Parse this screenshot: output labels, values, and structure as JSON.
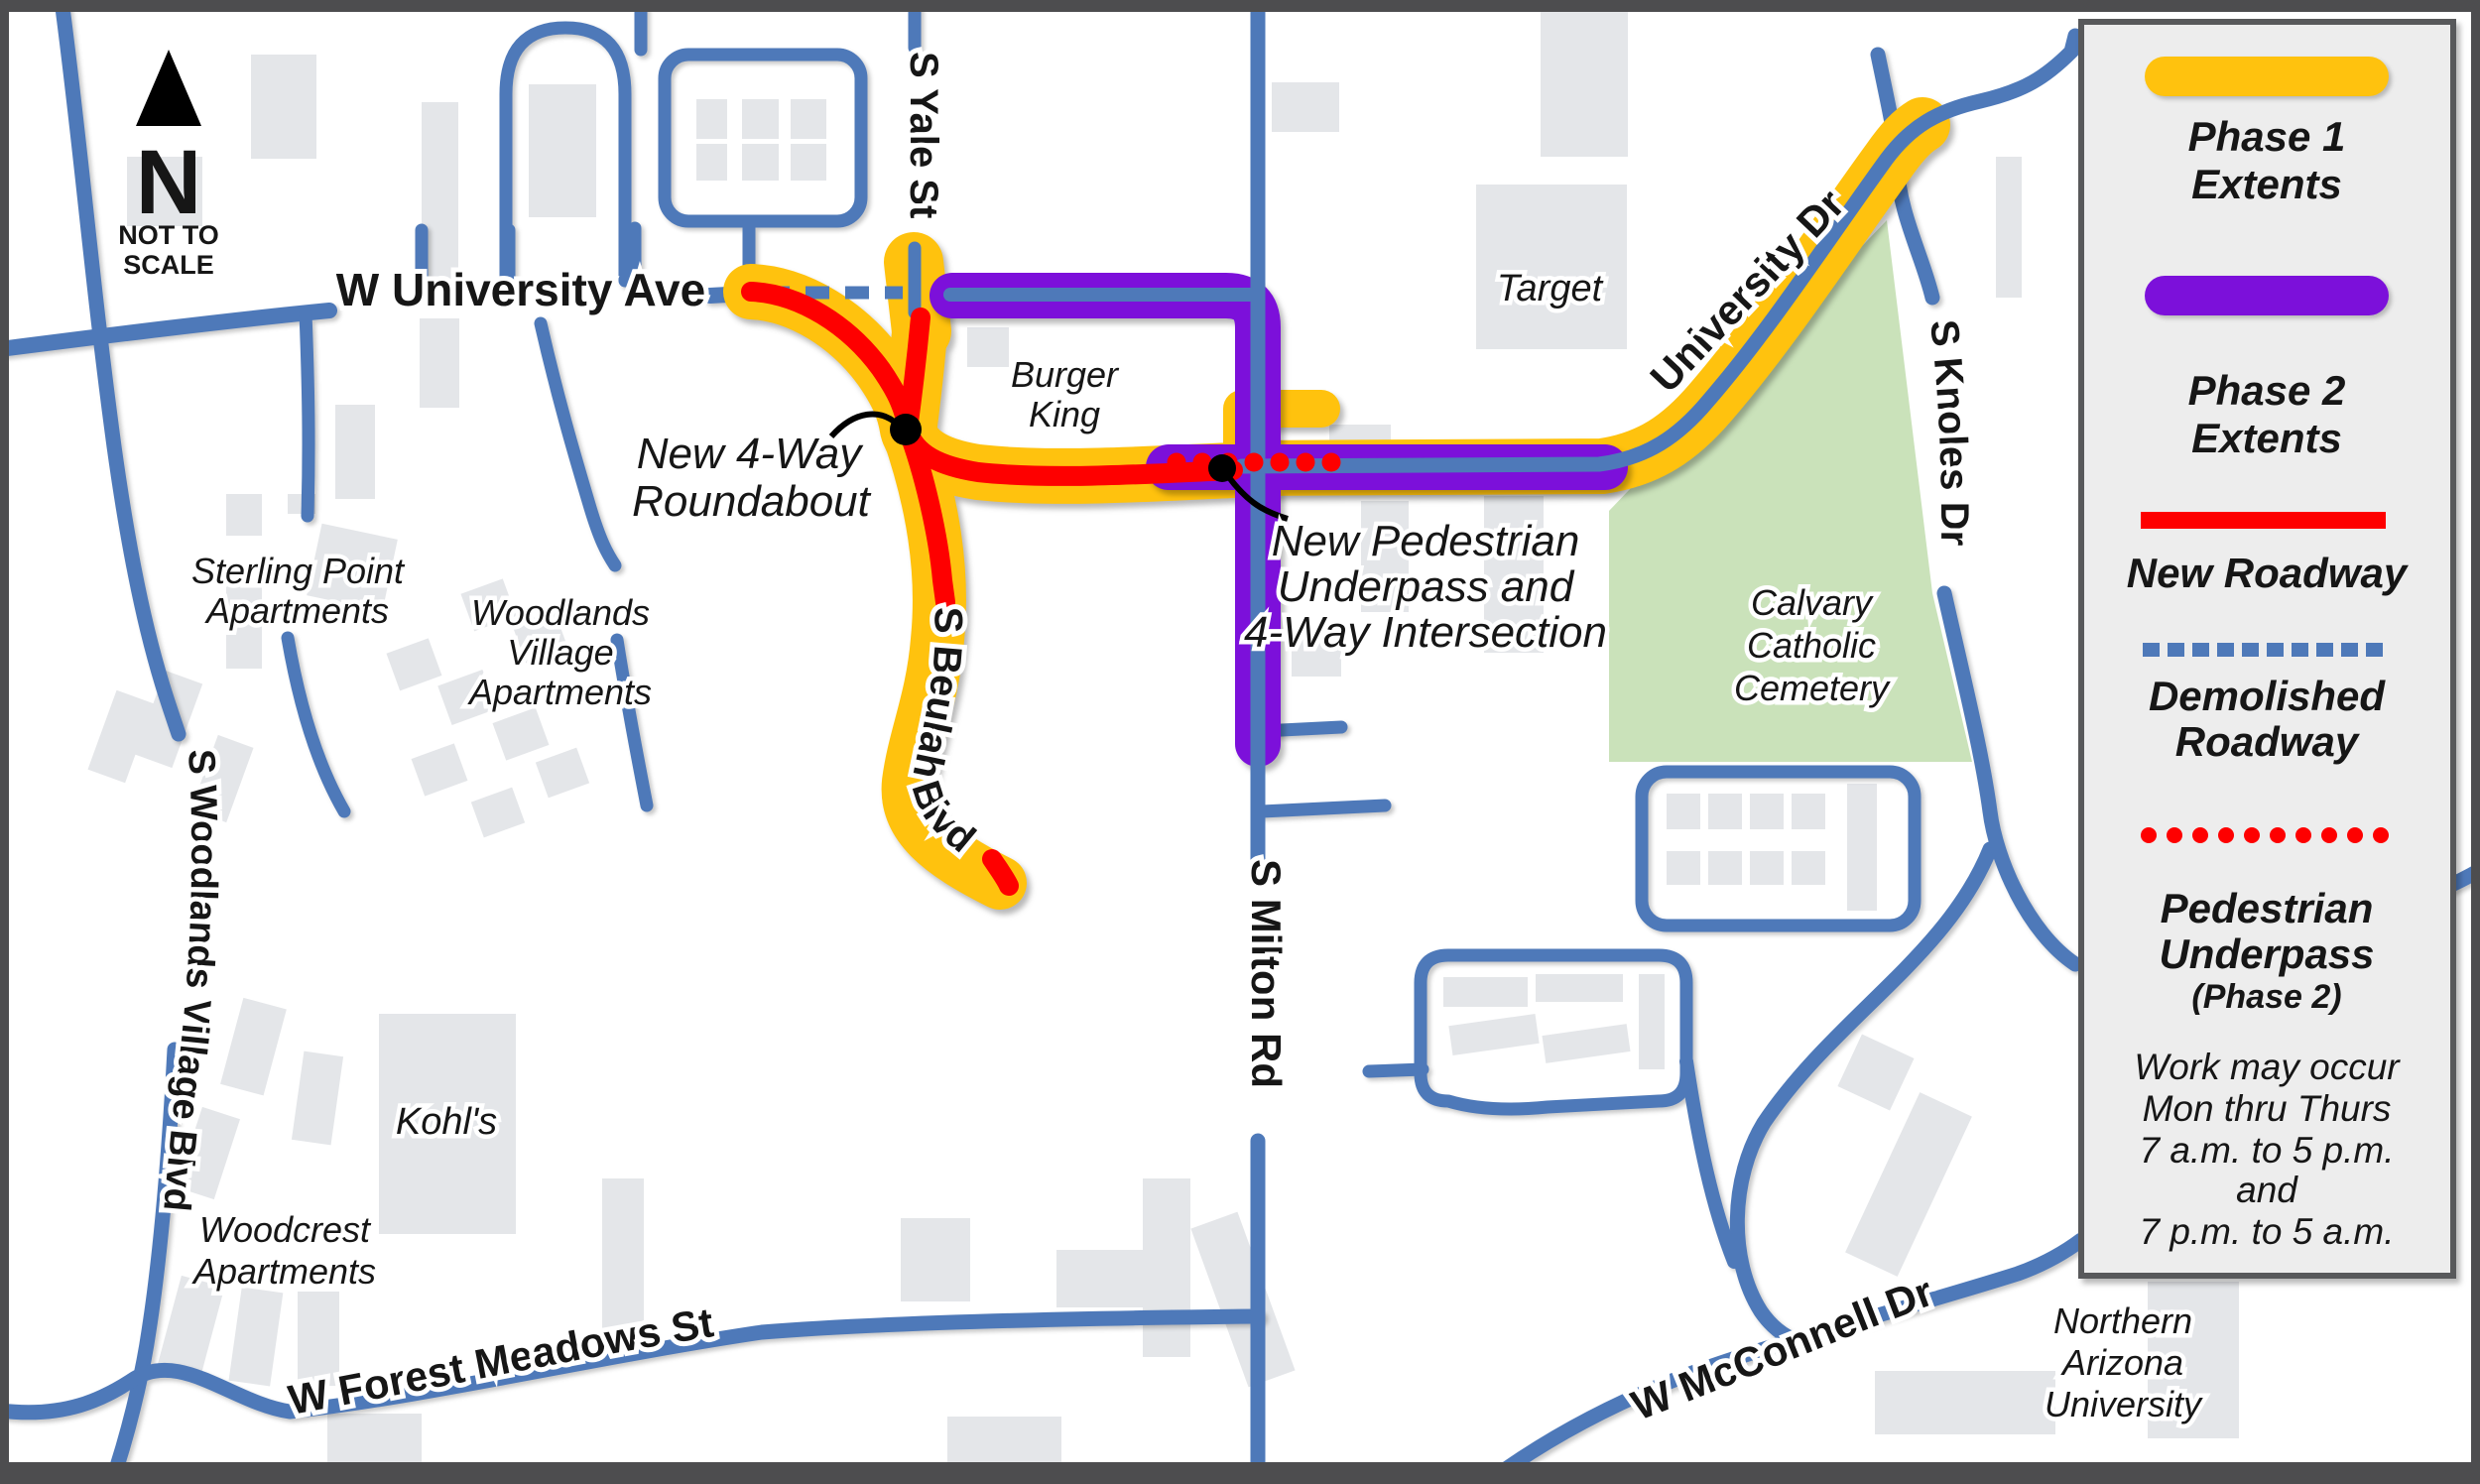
{
  "map": {
    "north": {
      "letter": "N",
      "line1": "NOT TO",
      "line2": "SCALE"
    },
    "streets": {
      "university_ave": "W University Ave",
      "yale": "S Yale St",
      "beulah": "S Beulah Blvd",
      "milton": "S Milton Rd",
      "university_dr": "University Dr",
      "knoles": "S Knoles Dr",
      "woodlands": "S Woodlands Village Blvd",
      "forest": "W Forest Meadows St",
      "mcconnell": "W McConnell Dr"
    },
    "places": {
      "sterling": [
        "Sterling Point",
        "Apartments"
      ],
      "woodlands_village": [
        "Woodlands",
        "Village",
        "Apartments"
      ],
      "woodcrest": [
        "Woodcrest",
        "Apartments"
      ],
      "kohls": "Kohl's",
      "burger_king": [
        "Burger",
        "King"
      ],
      "target": "Target",
      "cemetery": [
        "Calvary",
        "Catholic",
        "Cemetery"
      ],
      "nau": [
        "Northern",
        "Arizona",
        "University"
      ]
    },
    "annotations": {
      "roundabout": [
        "New 4-Way",
        "Roundabout"
      ],
      "underpass": [
        "New Pedestrian",
        "Underpass and",
        "4-Way Intersection"
      ]
    }
  },
  "legend": {
    "phase1": [
      "Phase 1",
      "Extents"
    ],
    "phase2": [
      "Phase 2",
      "Extents"
    ],
    "new_roadway": "New Roadway",
    "demolished": [
      "Demolished",
      "Roadway"
    ],
    "pedestrian": [
      "Pedestrian",
      "Underpass",
      "(Phase 2)"
    ],
    "note": [
      "Work may occur",
      "Mon thru Thurs",
      "7 a.m. to 5 p.m.",
      "and",
      "7 p.m. to 5 a.m."
    ]
  },
  "colors": {
    "phase1": "#FFC20E",
    "phase2": "#7C10DA",
    "new_roadway": "#FE0000",
    "road_blue": "#4E79B9",
    "building_gray": "#E4E6E9",
    "cemetery_green": "#CAE2BA",
    "legend_bg": "#EDEDED",
    "frame": "#4D4D4F"
  }
}
